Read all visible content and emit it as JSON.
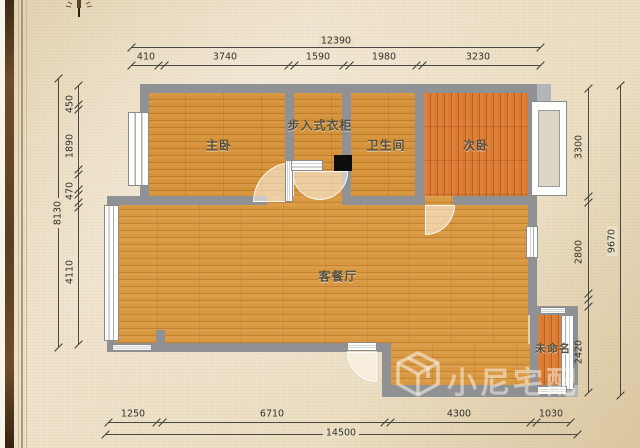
{
  "plan_title": "floor-plan",
  "rooms": [
    {
      "id": "master-bedroom",
      "label": "主卧"
    },
    {
      "id": "walk-in-closet",
      "label": "步入式衣柜"
    },
    {
      "id": "bathroom",
      "label": "卫生间"
    },
    {
      "id": "second-bedroom",
      "label": "次卧"
    },
    {
      "id": "living-dining-room",
      "label": "客餐厅"
    },
    {
      "id": "unnamed-room",
      "label": "未命名"
    }
  ],
  "dimensions": {
    "top": {
      "total": "12390",
      "segments": [
        "410",
        "3740",
        "1590",
        "1980",
        "3230"
      ]
    },
    "left": {
      "total": "8130",
      "segments": [
        "450",
        "1890",
        "470",
        "4110"
      ]
    },
    "right": {
      "total": "9670",
      "segments": [
        "3300",
        "2800",
        "2420"
      ]
    },
    "bottom": {
      "total": "14500",
      "segments": [
        "1250",
        "6710",
        "4300",
        "1030"
      ]
    }
  },
  "watermark": {
    "text": "小尼宅配"
  },
  "colors": {
    "background_parchment": "#ecdfc4",
    "wall_gray": "#8f9194",
    "floor_wood_orange": "#d69239",
    "floor_wood_red": "#db7a31",
    "border_brown": "#5b3d20",
    "dimension_ink": "#33322b"
  }
}
